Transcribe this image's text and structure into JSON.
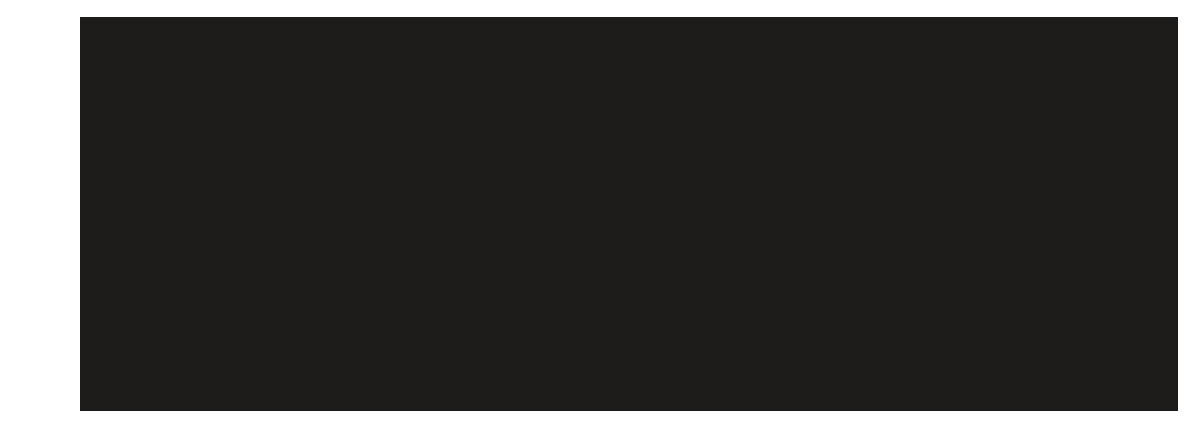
{
  "page": {
    "background_color": "#ffffff"
  },
  "display": {
    "description": "blank-black-screen",
    "background_color": "#1e1c1b",
    "content_text": ""
  }
}
